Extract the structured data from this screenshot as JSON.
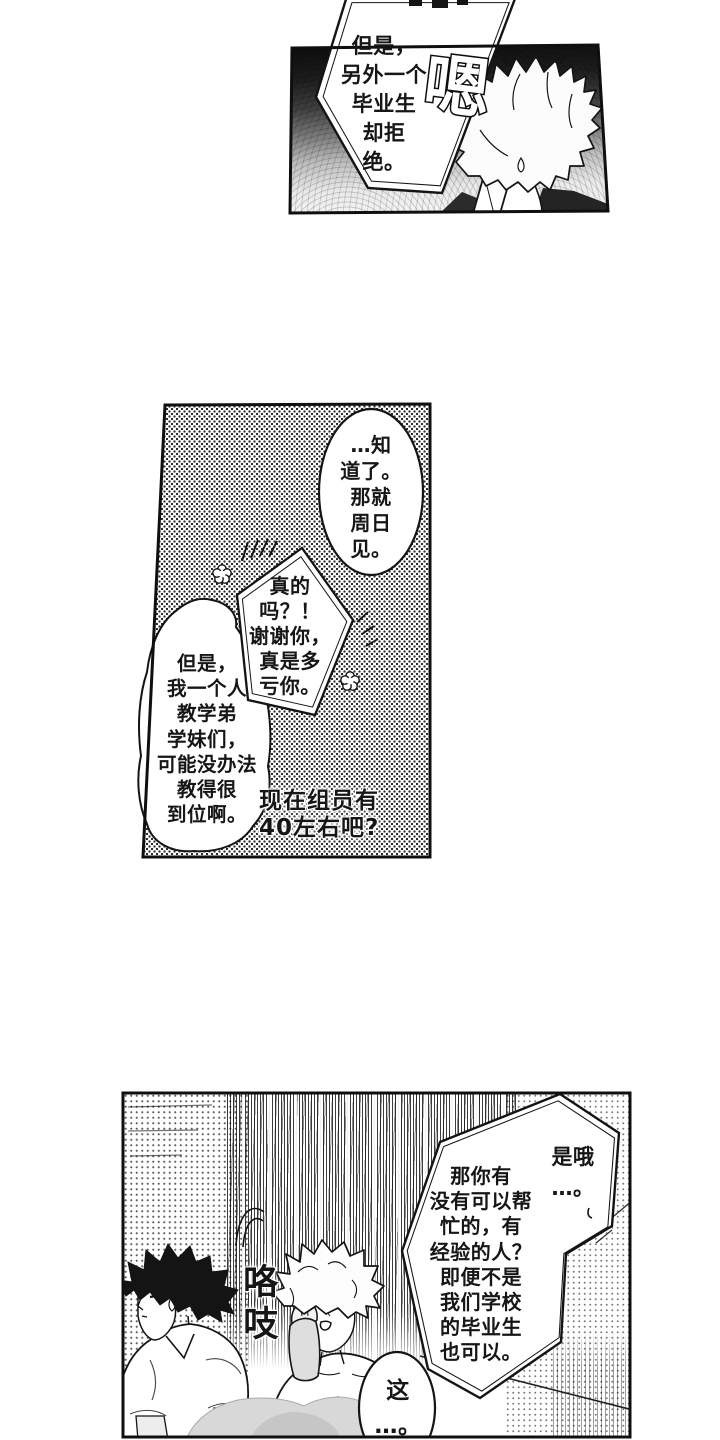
{
  "meta": {
    "ink": "#141414",
    "paper": "#ffffff",
    "type": "manga-page"
  },
  "panel1": {
    "bubble_refuse": {
      "lines": [
        "但是，",
        "另外一个",
        "毕业生",
        "却拒",
        "绝。"
      ]
    },
    "sfx_hm": "嗯"
  },
  "panel2": {
    "bubble_know": {
      "lines": [
        "…知",
        "道了。",
        "那就",
        "周日",
        "见。"
      ]
    },
    "bubble_really": {
      "lines": [
        "真的",
        "吗？！",
        "谢谢你，",
        "真是多",
        "亏你。"
      ]
    },
    "bubble_but": {
      "lines": [
        "但是，",
        "我一个人",
        "教学弟",
        "学妹们，",
        "可能没办法",
        "教得很",
        "到位啊。"
      ]
    },
    "caption_members": {
      "lines": [
        "现在组员有",
        "40左右吧?"
      ]
    }
  },
  "panel3": {
    "bubble_ask": {
      "lines": [
        "那你有",
        "没有可以帮",
        "忙的，有",
        "经验的人？",
        "即便不是",
        "我们学校",
        "的毕业生",
        "也可以。"
      ]
    },
    "reply_isok": {
      "lines": [
        "是哦",
        "…。"
      ]
    },
    "bubble_this": {
      "lines": [
        "这",
        "…。"
      ]
    },
    "sfx_scratch": {
      "chars": [
        "咯",
        "吱"
      ]
    }
  }
}
